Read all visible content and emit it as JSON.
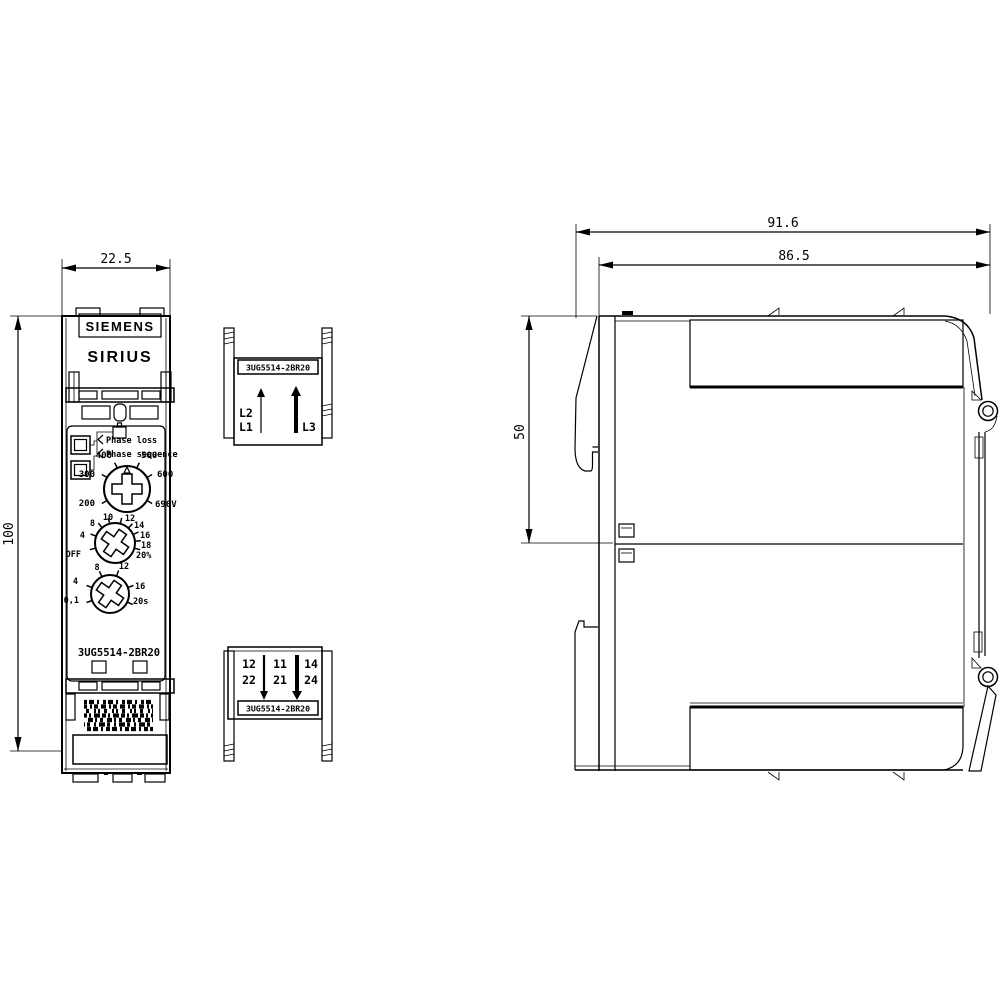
{
  "drawing_type": "dimensional drawing",
  "colors": {
    "line": "#000000",
    "background": "#ffffff"
  },
  "front": {
    "height_dim": "100",
    "width_dim": "22.5",
    "brand": "SIEMENS",
    "series": "SIRIUS",
    "part_number": "3UG5514-2BR20",
    "led_labels": [
      "Phase loss",
      "Phase sequence"
    ],
    "voltage_dial": [
      "400",
      "500",
      "300",
      "600",
      "200",
      "690V"
    ],
    "threshold_dial": [
      "OFF",
      "4",
      "8",
      "10",
      "12",
      "14",
      "16",
      "18",
      "20%"
    ],
    "time_dial": [
      "0,1",
      "4",
      "8",
      "12",
      "16",
      "20s"
    ]
  },
  "top_connector": {
    "part_number": "3UG5514-2BR20",
    "terminals": [
      "L2",
      "L1",
      "L3"
    ]
  },
  "bottom_connector": {
    "part_number": "3UG5514-2BR20",
    "row1": [
      "12",
      "11",
      "14"
    ],
    "row2": [
      "22",
      "21",
      "24"
    ]
  },
  "side": {
    "width_overall": "91.6",
    "width_body": "86.5",
    "height_upper": "50"
  }
}
